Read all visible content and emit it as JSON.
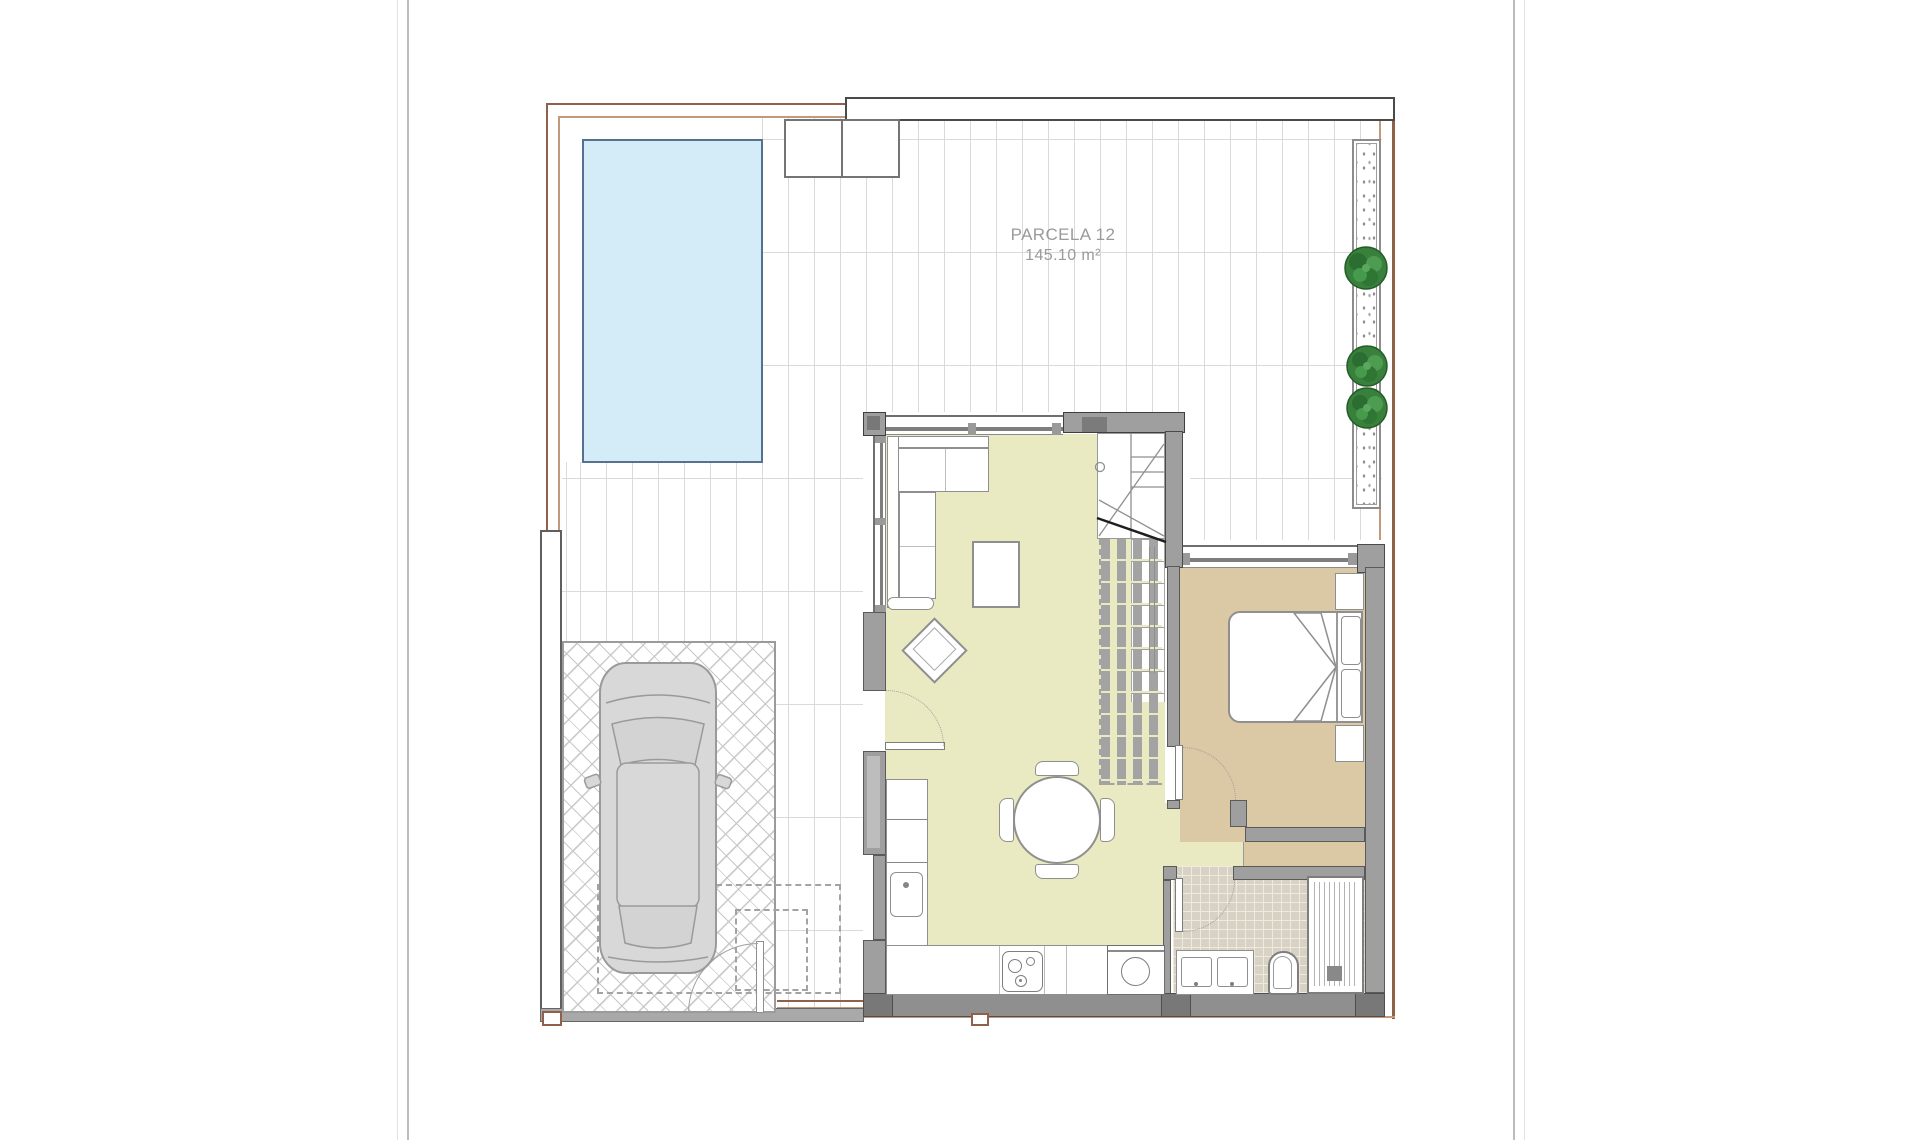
{
  "page": {
    "labels": {
      "parcel_name": "PARCELA 12",
      "parcel_area": "145.10 m²"
    }
  },
  "colors": {
    "pool_fill": "#d4ecf8",
    "pool_border": "#55718d",
    "floor_living": "#e9e9c2",
    "floor_bedroom": "#dbc8a4",
    "floor_bath": "#d8d2c5",
    "wall": "#9f9f9f",
    "wall_exterior": "#8f8f8f",
    "boundary_brown": "#8f6148",
    "boundary_brown_light": "#c2997b",
    "tile_line": "#dadada",
    "paving_line": "#c8c8c8",
    "plant_green": "#38803c",
    "furniture_stroke": "#8f8f8f",
    "text_gray": "#9a9a9a"
  }
}
